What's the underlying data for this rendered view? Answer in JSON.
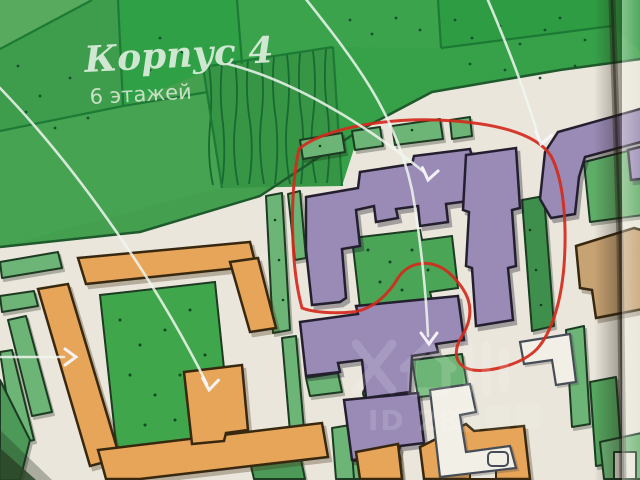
{
  "plan": {
    "building_label": "Корпус 4",
    "floors_label": "6 этажей"
  },
  "watermark": {
    "id_text": "ID 28",
    "logo": "house-icon",
    "id_partially_obscured": true
  },
  "annotations": {
    "arrow_count": 5,
    "red_circle_color": "#d42a1c",
    "callout_color": "#f4f2ee"
  },
  "colors": {
    "park_green": "#3aa34c",
    "hedge_green": "#6db576",
    "purple_building": "#998ab6",
    "orange_building": "#e6a558",
    "tan_building": "#c7a273",
    "road_paper": "#eae6db"
  }
}
